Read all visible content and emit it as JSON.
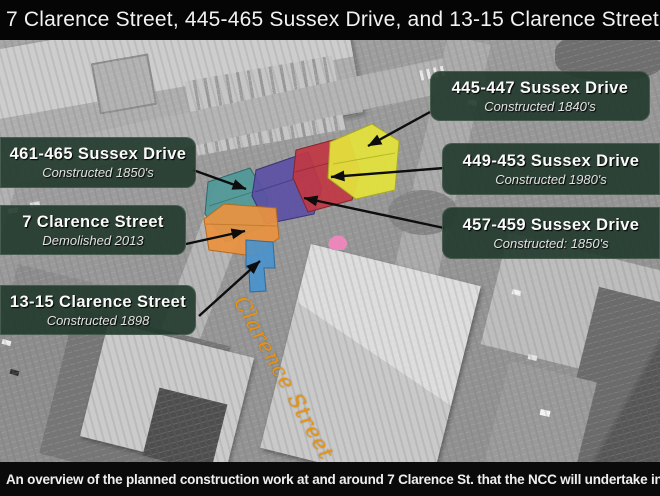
{
  "title_bar": {
    "title": "7 Clarence Street, 445-465 Sussex Drive, and 13-15 Clarence Street"
  },
  "caption_bar": {
    "caption": "An overview of the planned construction work at and around 7 Clarence St. that the NCC will undertake in 2016."
  },
  "street_label": "Clarence Street",
  "callouts": [
    {
      "title": "445-447 Sussex Drive",
      "subtitle": "Constructed 1840's"
    },
    {
      "title": "461-465 Sussex Drive",
      "subtitle": "Constructed 1850's"
    },
    {
      "title": "449-453 Sussex Drive",
      "subtitle": "Constructed 1980's"
    },
    {
      "title": "7 Clarence Street",
      "subtitle": "Demolished 2013"
    },
    {
      "title": "457-459 Sussex Drive",
      "subtitle": "Constructed: 1850's"
    },
    {
      "title": "13-15 Clarence Street",
      "subtitle": "Constructed 1898"
    }
  ],
  "building_overlays": [
    {
      "name": "445-447 Sussex Drive",
      "color": "#e3e33c"
    },
    {
      "name": "449-453 Sussex Drive",
      "color": "#c03743"
    },
    {
      "name": "457-459 Sussex Drive",
      "color": "#5b50a4"
    },
    {
      "name": "461-465 Sussex Drive",
      "color": "#4f9898"
    },
    {
      "name": "7 Clarence Street",
      "color": "#ea9240"
    },
    {
      "name": "13-15 Clarence Street",
      "color": "#4a92cc"
    },
    {
      "name": "dome accent",
      "color": "#f086bd"
    }
  ],
  "colors": {
    "callout_background": "#21382b",
    "arrow": "#0d0d0d",
    "street_text": "#e8930f",
    "title_background": "#050505"
  }
}
